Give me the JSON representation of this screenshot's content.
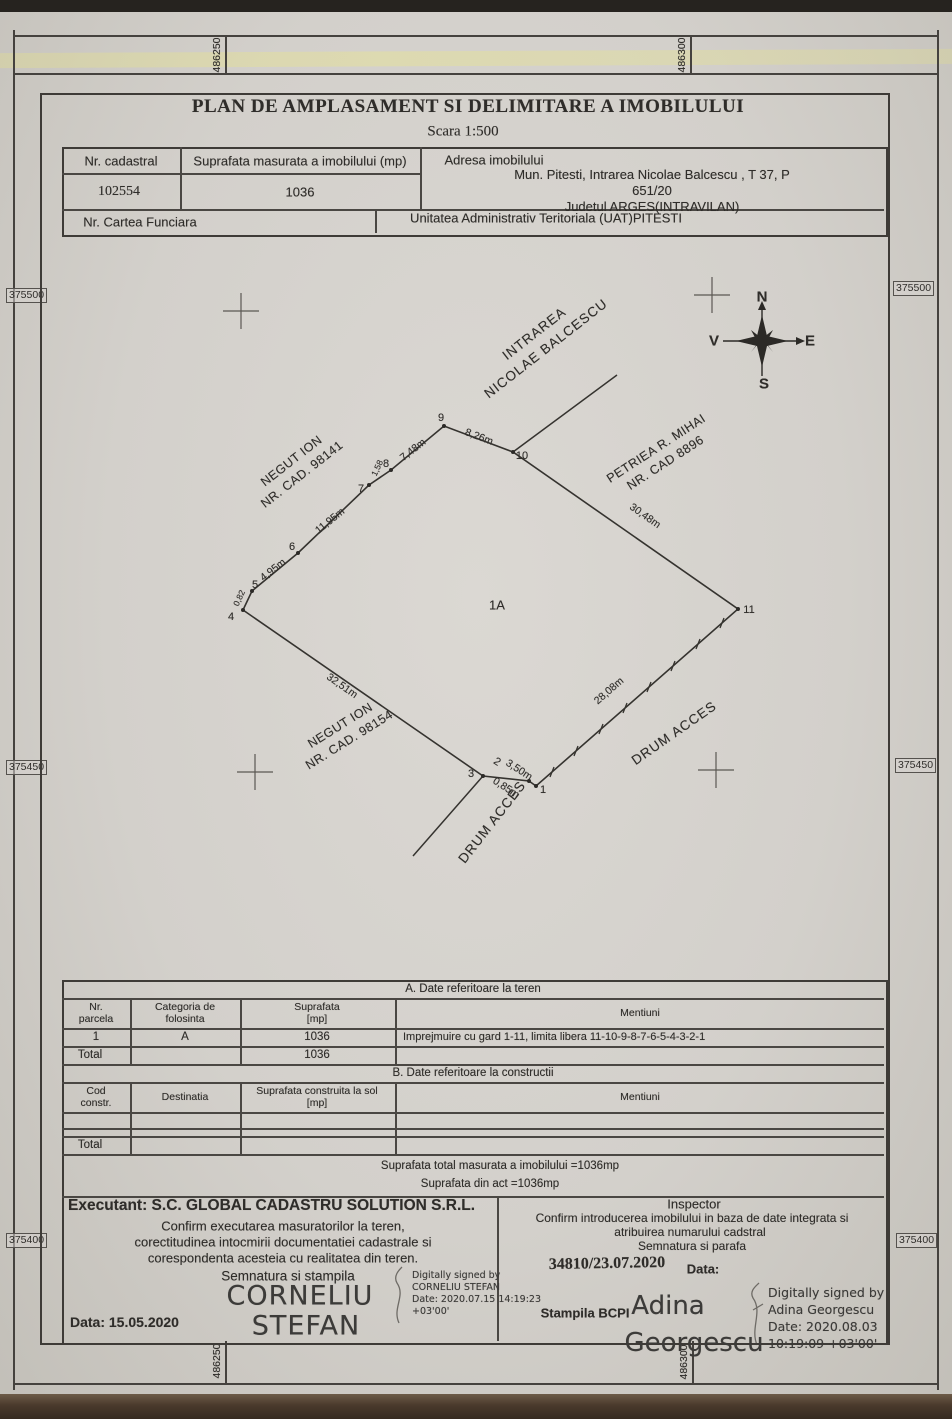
{
  "doc": {
    "title": "PLAN DE AMPLASAMENT SI DELIMITARE A IMOBILULUI",
    "scale": "Scara  1:500"
  },
  "header_table": {
    "nr_cadastral_label": "Nr. cadastral",
    "suprafata_label": "Suprafata masurata a imobilului (mp)",
    "adresa_label": "Adresa imobilului",
    "nr_cadastral_value": "102554",
    "suprafata_value": "1036",
    "adresa_value": "Mun. Pitesti, Intrarea Nicolae Balcescu , T 37,  P 651/20\nJudetul  ARGES(INTRAVILAN)",
    "cartea_funciara_label": "Nr. Cartea Funciara",
    "uat_value": "Unitatea Administrativ Teritoriala (UAT)PITESTI"
  },
  "grid_coords": {
    "top": [
      "486250",
      "486300"
    ],
    "bottom": [
      "486250",
      "486300"
    ],
    "left": [
      "375500",
      "375450",
      "375400"
    ],
    "right": [
      "375500",
      "375450",
      "375400"
    ]
  },
  "compass": {
    "n": "N",
    "e": "E",
    "s": "S",
    "v": "V"
  },
  "map": {
    "street": {
      "line1": "INTRAREA",
      "line2": "NICOLAE BALCESCU"
    },
    "owner_nw": {
      "line1": "NEGUT ION",
      "line2": "NR. CAD. 98141"
    },
    "owner_ne": {
      "line1": "PETRIEA R. MIHAI",
      "line2": "NR. CAD 8896"
    },
    "owner_sw": {
      "line1": "NEGUT ION",
      "line2": "NR. CAD. 98154"
    },
    "parcel_label": "1A",
    "road_sw": "DRUM ACCES",
    "road_se": "DRUM ACCES",
    "points": [
      "1",
      "2",
      "3",
      "4",
      "5",
      "6",
      "7",
      "8",
      "9",
      "10",
      "11"
    ],
    "measurements": {
      "seg_9_10": "8,26m",
      "seg_8_9": "7,48m",
      "seg_7_8": "1,58",
      "seg_6_7": "11,95m",
      "seg_5_6": "4,95m",
      "seg_4_5": "0,82",
      "seg_10_11": "30,48m",
      "seg_11_1": "28,08m",
      "seg_3_2": "3,50m",
      "seg_2_1": "0,85m",
      "seg_4_3": "32,51m"
    }
  },
  "table_a": {
    "section_title": "A. Date referitoare la teren",
    "headers": [
      "Nr.\nparcela",
      "Categoria de\nfolosinta",
      "Suprafata\n[mp]",
      "Mentiuni"
    ],
    "rows": [
      [
        "1",
        "A",
        "1036",
        "Imprejmuire cu gard 1-11, limita libera 11-10-9-8-7-6-5-4-3-2-1"
      ]
    ],
    "total_label": "Total",
    "total_value": "1036"
  },
  "table_b": {
    "section_title": "B. Date referitoare la constructii",
    "headers": [
      "Cod\nconstr.",
      "Destinatia",
      "Suprafata construita la sol\n[mp]",
      "Mentiuni"
    ],
    "total_label": "Total"
  },
  "totals": {
    "line1": "Suprafata total masurata a imobilului =1036mp",
    "line2": "Suprafata din act  =1036mp"
  },
  "executant": {
    "title": "Executant: S.C. GLOBAL CADASTRU SOLUTION S.R.L.",
    "confirm1": "Confirm executarea masuratorilor la teren,",
    "confirm2": "corectitudinea intocmirii documentatiei cadastrale si",
    "confirm3": "corespondenta acesteia cu realitatea din teren.",
    "semnatura_label": "Semnatura si stampila",
    "sign_line1": "CORNELIU",
    "sign_line2": "STEFAN",
    "date": "Data: 15.05.2020",
    "digital_note": "Digitally signed by\nCORNELIU STEFAN\nDate: 2020.07.15 14:19:23\n+03'00'"
  },
  "inspector": {
    "title": "Inspector",
    "confirm1": "Confirm introducerea imobilului in baza de date integrata si",
    "confirm2": "atribuirea numarului cadstral",
    "semnatura_label": "Semnatura si parafa",
    "stamp_number": "34810/23.07.2020",
    "date_label": "Data:",
    "stampila_label": "Stampila BCPI",
    "sign_line1": "Adina",
    "sign_line2": "Georgescu",
    "digital_note": "Digitally signed by\nAdina Georgescu\nDate: 2020.08.03\n10:19:09 +03'00'"
  }
}
